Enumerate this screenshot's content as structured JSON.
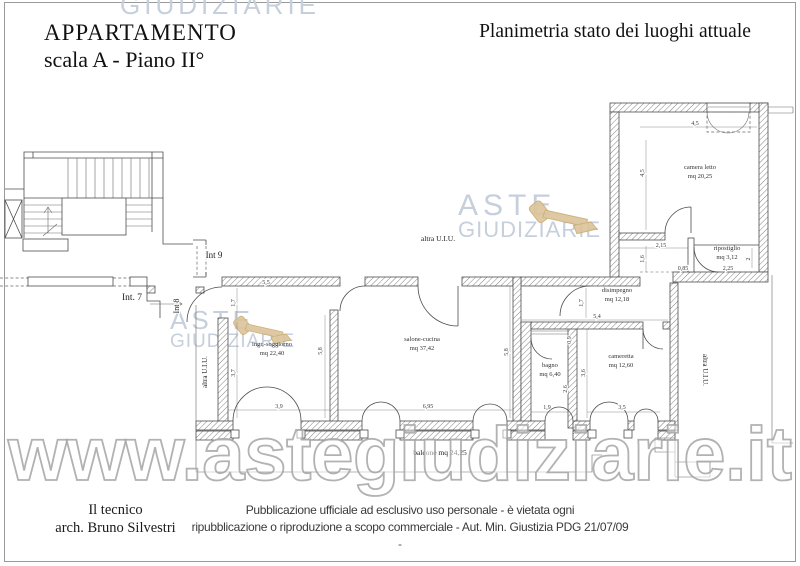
{
  "page": {
    "title1": "APPARTAMENTO",
    "title2": "scala A - Piano II°",
    "subtitle": "Planimetria stato dei luoghi attuale"
  },
  "watermarks": {
    "top_fragment": "GIUDIZIARIE",
    "brand_line1": "ASTE",
    "brand_line2": "GIUDIZIARIE",
    "url": "www.astegiudiziarie.it"
  },
  "plan": {
    "rooms": [
      {
        "name": "camera letto",
        "area": "mq 20,25",
        "x": 700,
        "y": 169
      },
      {
        "name": "ripostiglio",
        "area": "mq 3,12",
        "x": 727,
        "y": 250
      },
      {
        "name": "disimpegno",
        "area": "mq 12,18",
        "x": 617,
        "y": 292
      },
      {
        "name": "cameretta",
        "area": "mq 12,60",
        "x": 621,
        "y": 358
      },
      {
        "name": "bagno",
        "area": "mq 6,40",
        "x": 550,
        "y": 367
      },
      {
        "name": "salone-cucina",
        "area": "mq 37,42",
        "x": 422,
        "y": 341
      },
      {
        "name": "ingr.-soggiorno",
        "area": "mq 22,40",
        "x": 272,
        "y": 346
      }
    ],
    "labels": [
      {
        "text": "Int 9",
        "x": 214,
        "y": 258,
        "fs": 9
      },
      {
        "text": "Int. 7",
        "x": 132,
        "y": 300,
        "fs": 9.5
      },
      {
        "text": "Int 8",
        "x": 179,
        "y": 306,
        "rot": -90,
        "fs": 8
      },
      {
        "text": "altra U.I.U.",
        "x": 438,
        "y": 241,
        "fs": 7.5
      },
      {
        "text": "altra U.I.U.",
        "x": 207,
        "y": 372,
        "rot": -90,
        "fs": 7
      },
      {
        "text": "altra U.I.U.",
        "x": 703,
        "y": 370,
        "rot": 90,
        "fs": 7
      },
      {
        "text": "balcone mq 24,25",
        "x": 440,
        "y": 455,
        "fs": 7.5
      }
    ],
    "dimensions": [
      {
        "text": "4,5",
        "x": 695,
        "y": 125
      },
      {
        "text": "4,5",
        "x": 644,
        "y": 173,
        "rot": -90
      },
      {
        "text": "2,15",
        "x": 661,
        "y": 247
      },
      {
        "text": "1,6",
        "x": 644,
        "y": 259,
        "rot": -90
      },
      {
        "text": "0,85",
        "x": 683,
        "y": 270
      },
      {
        "text": "2,25",
        "x": 728,
        "y": 270
      },
      {
        "text": "2",
        "x": 750,
        "y": 259,
        "rot": -90
      },
      {
        "text": "5,5",
        "x": 266,
        "y": 284
      },
      {
        "text": "1,7",
        "x": 235,
        "y": 303,
        "rot": -90
      },
      {
        "text": "3,7",
        "x": 235,
        "y": 373,
        "rot": -90
      },
      {
        "text": "5,8",
        "x": 322,
        "y": 351,
        "rot": -90
      },
      {
        "text": "3,9",
        "x": 279,
        "y": 408
      },
      {
        "text": "6,95",
        "x": 428,
        "y": 408
      },
      {
        "text": "5,8",
        "x": 508,
        "y": 352,
        "rot": -90
      },
      {
        "text": "1,7",
        "x": 583,
        "y": 303,
        "rot": -90
      },
      {
        "text": "5,4",
        "x": 597,
        "y": 318
      },
      {
        "text": "0,9",
        "x": 571,
        "y": 340,
        "rot": -90
      },
      {
        "text": "3,6",
        "x": 585,
        "y": 373,
        "rot": -90
      },
      {
        "text": "2,6",
        "x": 567,
        "y": 389,
        "rot": -90
      },
      {
        "text": "1,9",
        "x": 547,
        "y": 409
      },
      {
        "text": "3,5",
        "x": 622,
        "y": 409
      }
    ]
  },
  "footer": {
    "tech_line1": "Il tecnico",
    "tech_line2": "arch. Bruno Silvestri",
    "disclaimer_line1": "Pubblicazione ufficiale ad esclusivo uso personale - è vietata ogni",
    "disclaimer_line2": "ripubblicazione o riproduzione a scopo commerciale - Aut. Min. Giustizia PDG 21/07/09",
    "disclaimer_line3": "-"
  }
}
